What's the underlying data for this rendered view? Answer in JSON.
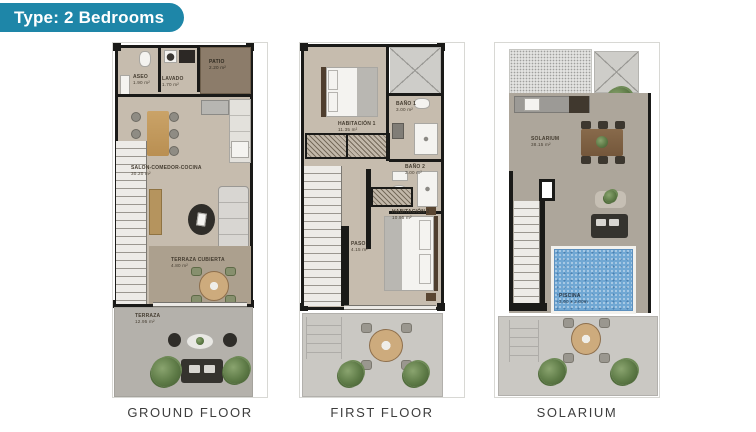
{
  "badge": {
    "label": "Type: 2 Bedrooms"
  },
  "colors": {
    "badge_bg": "#1e86a8",
    "wall": "#1a1a18",
    "floor_beige": "#c6bcae",
    "terrace_gray": "#b4b1ab",
    "patio_brown": "#8c7c6a",
    "pool_blue": "#70a7d3"
  },
  "plans": [
    {
      "id": "ground-floor",
      "caption": "GROUND FLOOR",
      "rooms": {
        "aseo": {
          "label": "ASEO",
          "area": "1.90 m²"
        },
        "lavado": {
          "label": "LAVADO",
          "area": "1.70 m²"
        },
        "patio": {
          "label": "PATIO",
          "area": "2.20 m²"
        },
        "salon": {
          "label": "SALON-COMEDOR-COCINA",
          "area": "30.20 m²"
        },
        "terraza_cubierta": {
          "label": "TERRAZA CUBIERTA",
          "area": "4.80 m²"
        },
        "terraza": {
          "label": "TERRAZA",
          "area": "12.95 m²"
        }
      }
    },
    {
      "id": "first-floor",
      "caption": "FIRST FLOOR",
      "rooms": {
        "habitacion1": {
          "label": "HABITACIÓN 1",
          "area": "11.35 m²"
        },
        "bano1": {
          "label": "BAÑO 1",
          "area": "3.00 m²"
        },
        "bano2": {
          "label": "BAÑO 2",
          "area": "3.00 m²"
        },
        "paso": {
          "label": "PASO",
          "area": "4.15 m²"
        },
        "habitacion2": {
          "label": "HABITACIÓN 2",
          "area": "10.95 m²"
        }
      }
    },
    {
      "id": "solarium",
      "caption": "SOLARIUM",
      "rooms": {
        "solarium": {
          "label": "SOLARIUM",
          "area": "38.15 m²"
        },
        "piscina": {
          "label": "PISCINA",
          "area": "3.00 x 2.00m"
        }
      }
    }
  ]
}
